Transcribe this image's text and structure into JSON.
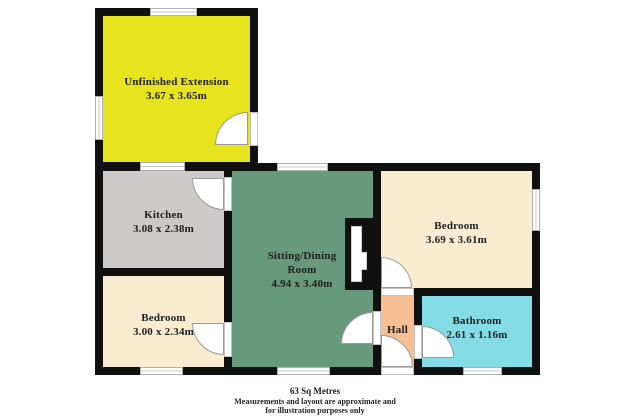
{
  "palette": {
    "background": "#ffffff",
    "wall": "#101010",
    "extension": "#e7e41e",
    "kitchen": "#cbcac8",
    "sitting": "#67997c",
    "bedroom": "#f9ecd1",
    "hall": "#f8bf92",
    "bathroom": "#83dce6",
    "window-fill": "#ffffff",
    "window-frame": "#b0b0b0",
    "door": "#ffffff",
    "door-stroke": "#9a9a9a",
    "label": "#1f1f1f"
  },
  "rooms": {
    "extension": {
      "name": "Unfinished Extension",
      "dims": "3.67 x 3.65m"
    },
    "kitchen": {
      "name": "Kitchen",
      "dims": "3.08 x 2.38m"
    },
    "sitting": {
      "name": "Sitting/Dining Room",
      "dims": "4.94 x 3.40m"
    },
    "bedroom1": {
      "name": "Bedroom",
      "dims": "3.69 x 3.61m"
    },
    "bedroom2": {
      "name": "Bedroom",
      "dims": "3.00 x 2.34m"
    },
    "hall": {
      "name": "Hall"
    },
    "bathroom": {
      "name": "Bathroom",
      "dims": "2.61 x 1.16m"
    }
  },
  "footer": {
    "area": "63 Sq Metres",
    "disclaimer_line1": "Measurements and layout are approximate and",
    "disclaimer_line2": "for illustration purposes only"
  }
}
